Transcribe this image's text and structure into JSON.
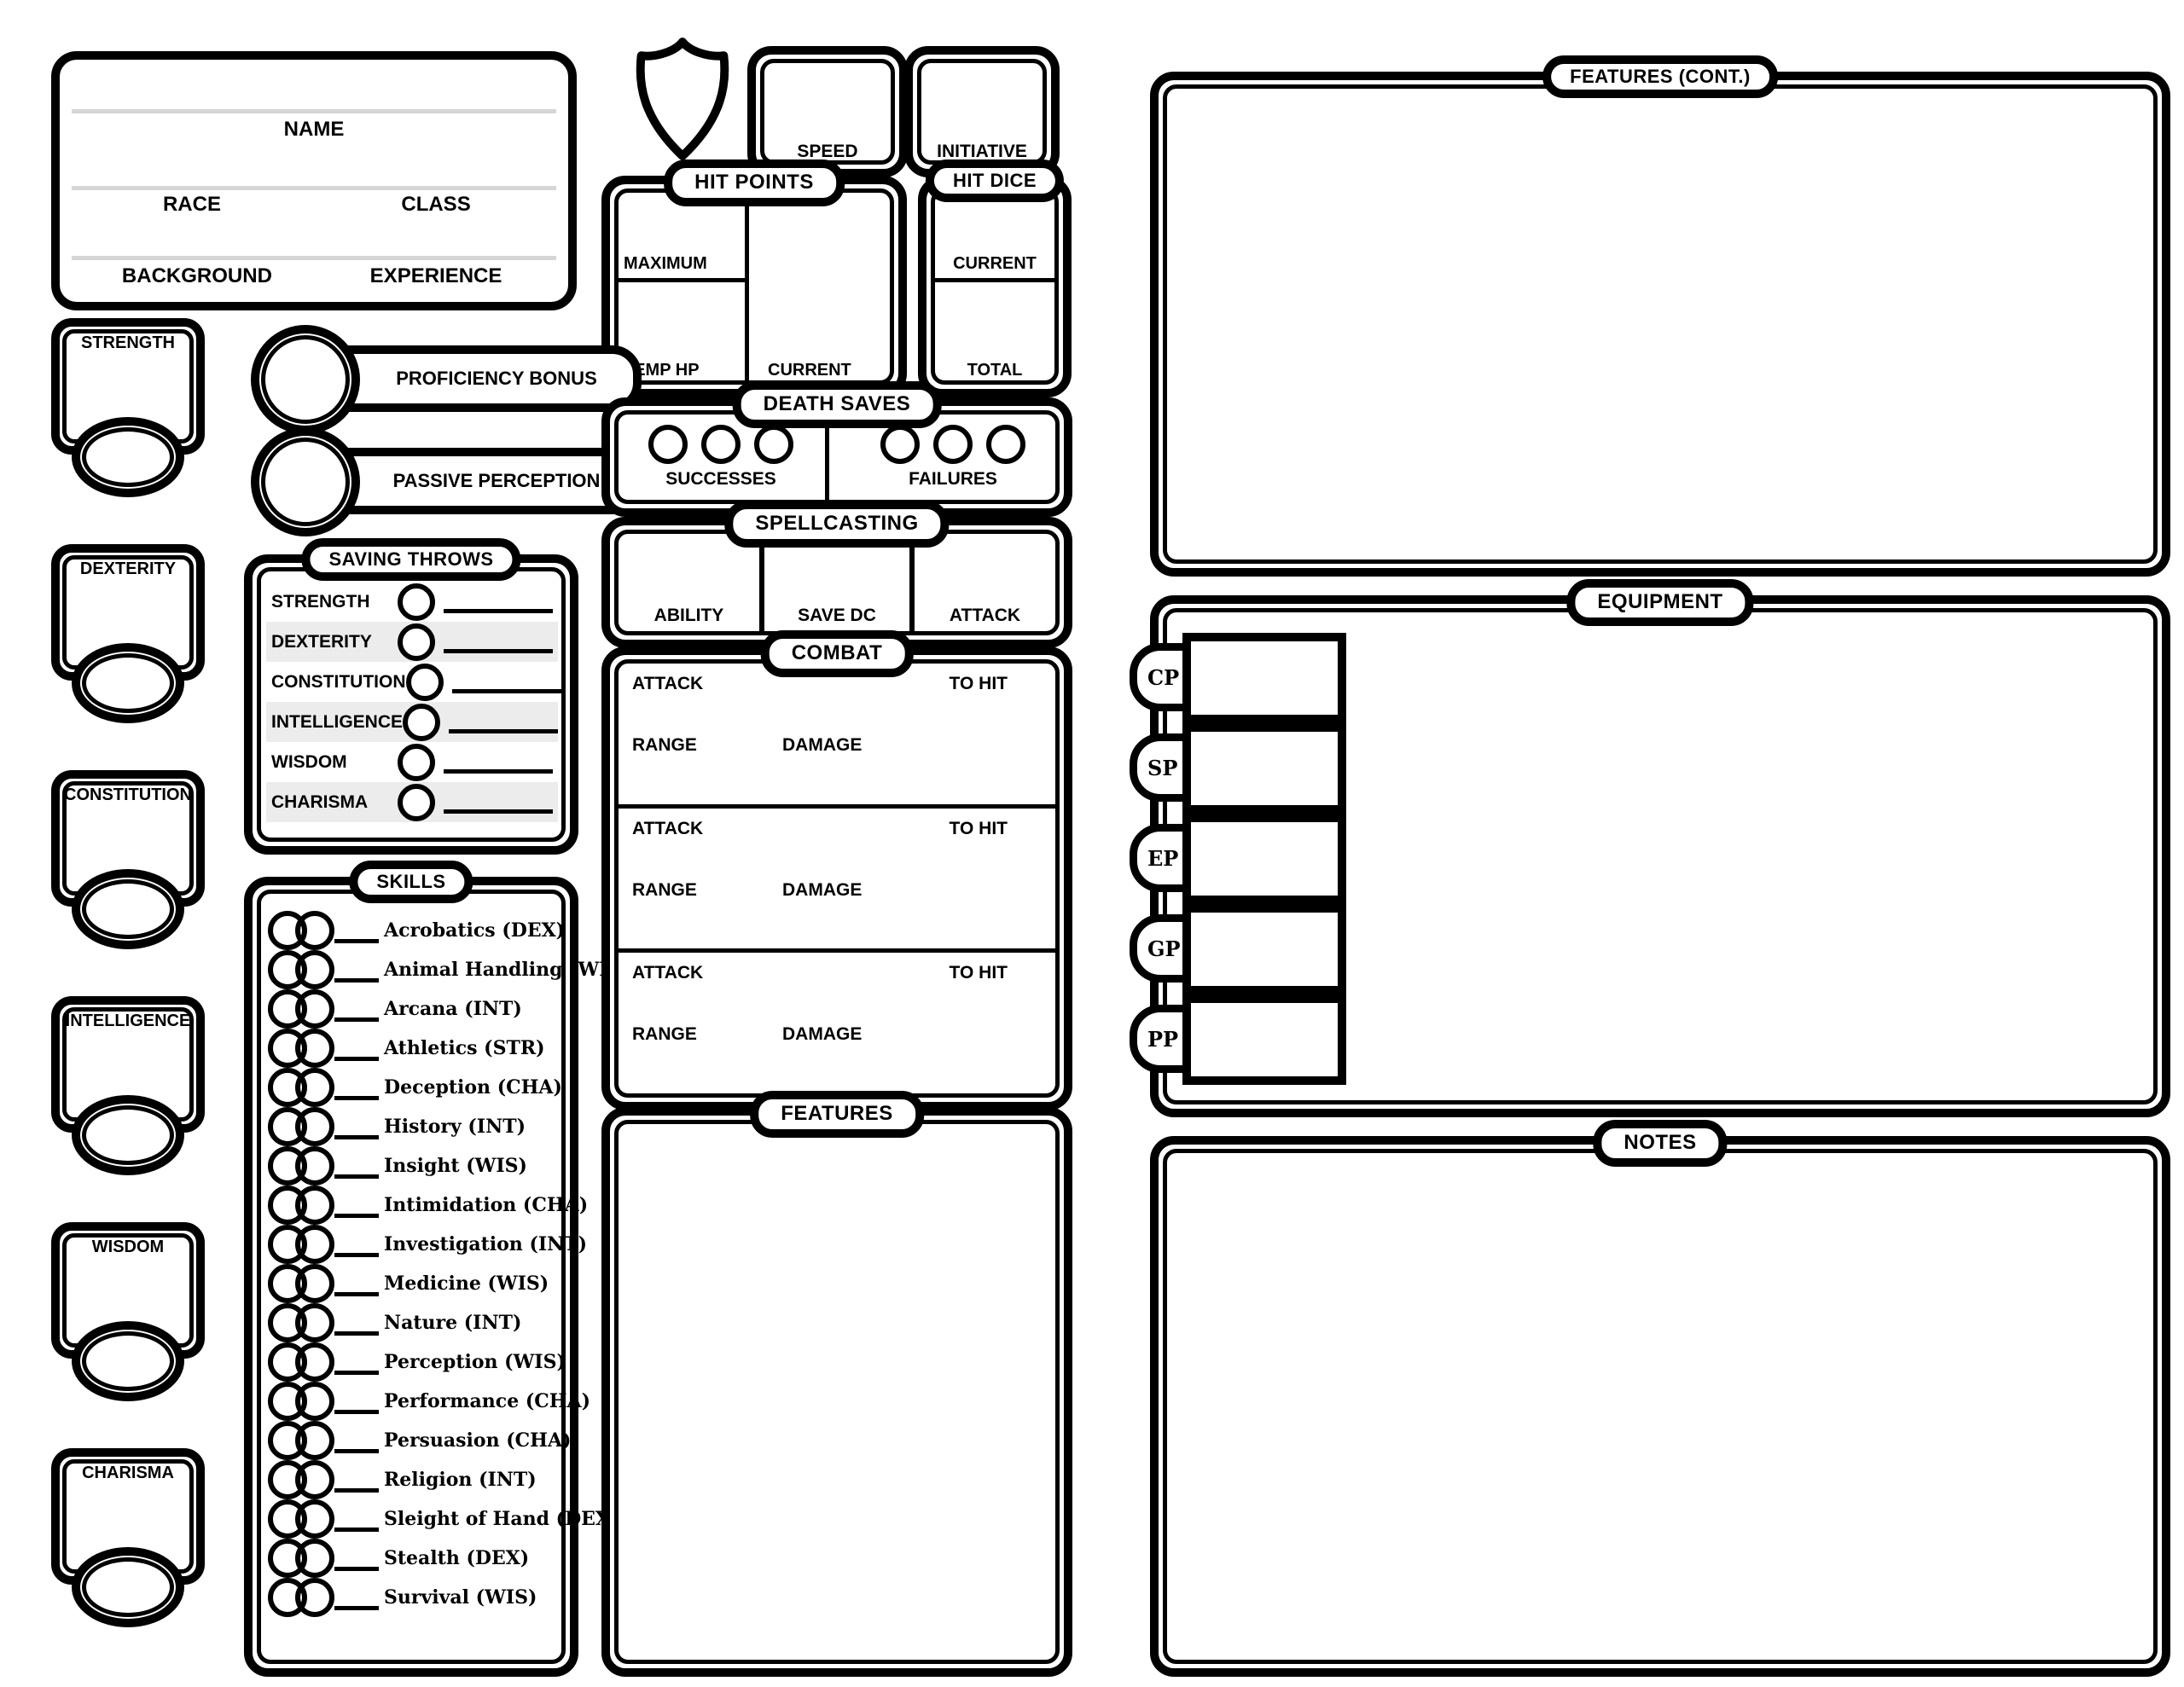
{
  "colors": {
    "ink": "#000000",
    "paper": "#ffffff",
    "row_shade": "#ececec",
    "rule_gray": "#d6d6d6"
  },
  "char_info": {
    "name_label": "NAME",
    "race_label": "RACE",
    "class_label": "CLASS",
    "background_label": "BACKGROUND",
    "experience_label": "EXPERIENCE"
  },
  "stats": {
    "speed_label": "SPEED",
    "initiative_label": "INITIATIVE",
    "proficiency_bonus_label": "PROFICIENCY BONUS",
    "passive_perception_label": "PASSIVE PERCEPTION"
  },
  "hit_points": {
    "title": "HIT POINTS",
    "maximum_label": "MAXIMUM",
    "temp_hp_label": "TEMP HP",
    "current_label": "CURRENT"
  },
  "hit_dice": {
    "title": "HIT DICE",
    "current_label": "CURRENT",
    "total_label": "TOTAL"
  },
  "death_saves": {
    "title": "DEATH SAVES",
    "successes_label": "SUCCESSES",
    "failures_label": "FAILURES",
    "checkboxes_per_side": 3
  },
  "spellcasting": {
    "title": "SPELLCASTING",
    "cells": [
      "ABILITY",
      "SAVE DC",
      "ATTACK"
    ]
  },
  "abilities": [
    "STRENGTH",
    "DEXTERITY",
    "CONSTITUTION",
    "INTELLIGENCE",
    "WISDOM",
    "CHARISMA"
  ],
  "saving_throws": {
    "title": "SAVING THROWS",
    "rows": [
      "STRENGTH",
      "DEXTERITY",
      "CONSTITUTION",
      "INTELLIGENCE",
      "WISDOM",
      "CHARISMA"
    ]
  },
  "skills": {
    "title": "SKILLS",
    "items": [
      "Acrobatics (DEX)",
      "Animal Handling (WIS)",
      "Arcana (INT)",
      "Athletics (STR)",
      "Deception (CHA)",
      "History (INT)",
      "Insight (WIS)",
      "Intimidation (CHA)",
      "Investigation (INT)",
      "Medicine (WIS)",
      "Nature (INT)",
      "Perception (WIS)",
      "Performance (CHA)",
      "Persuasion (CHA)",
      "Religion (INT)",
      "Sleight of Hand (DEX)",
      "Stealth (DEX)",
      "Survival (WIS)"
    ]
  },
  "combat": {
    "title": "COMBAT",
    "sections": 3,
    "attack_label": "ATTACK",
    "to_hit_label": "TO HIT",
    "range_label": "RANGE",
    "damage_label": "DAMAGE"
  },
  "features": {
    "title": "FEATURES"
  },
  "features_cont": {
    "title": "FEATURES (CONT.)"
  },
  "equipment": {
    "title": "EQUIPMENT",
    "currencies": [
      "CP",
      "SP",
      "EP",
      "GP",
      "PP"
    ]
  },
  "notes": {
    "title": "NOTES"
  }
}
